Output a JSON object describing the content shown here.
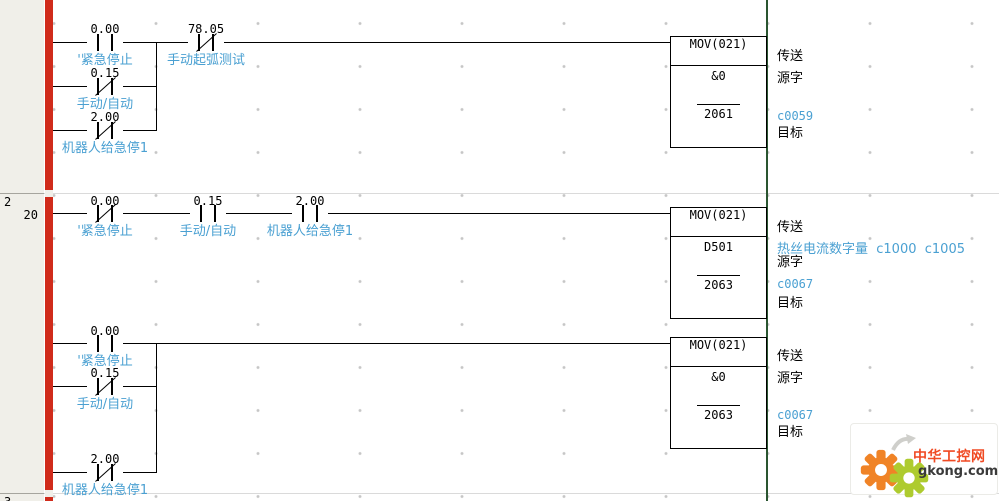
{
  "editor": {
    "left_margin": {
      "rung2_number": "2",
      "rung2_step": "20",
      "rung3_number": "3"
    }
  },
  "colors": {
    "left_bus_bar": "#d02b1b",
    "right_rail": "#2a5530",
    "comment_text": "#4aa0d2",
    "wire": "#000000",
    "margin_bg": "#f0efe9"
  },
  "rung1": {
    "contact_main1": {
      "address": "0.00",
      "label": "'紧急停止",
      "type": "NO"
    },
    "contact_main2": {
      "address": "78.05",
      "label": "手动起弧测试",
      "type": "NC"
    },
    "contact_branch1": {
      "address": "0.15",
      "label": "手动/自动",
      "type": "NC"
    },
    "contact_branch2": {
      "address": "2.00",
      "label": "机器人给急停1",
      "type": "NC"
    },
    "mov": {
      "name": "MOV(021)",
      "source": "&0",
      "dest": "2061"
    },
    "ann_transfer": "传送",
    "ann_source": "源字",
    "ann_dest_comment": "c0059",
    "ann_dest": "目标"
  },
  "rung2": {
    "contact1": {
      "address": "0.00",
      "label": "'紧急停止",
      "type": "NC"
    },
    "contact2": {
      "address": "0.15",
      "label": "手动/自动",
      "type": "NO"
    },
    "contact3": {
      "address": "2.00",
      "label": "机器人给急停1",
      "type": "NO"
    },
    "mov": {
      "name": "MOV(021)",
      "source": "D501",
      "dest": "2063"
    },
    "ann_transfer": "传送",
    "ann_source_comment": "热丝电流数字量  c1000  c1005",
    "ann_source": "源字",
    "ann_dest_comment": "c0067",
    "ann_dest": "目标"
  },
  "rung3": {
    "contact_main": {
      "address": "0.00",
      "label": "'紧急停止",
      "type": "NO"
    },
    "contact_branch1": {
      "address": "0.15",
      "label": "手动/自动",
      "type": "NC"
    },
    "contact_branch2": {
      "address": "2.00",
      "label": "机器人给急停1",
      "type": "NC"
    },
    "mov": {
      "name": "MOV(021)",
      "source": "&0",
      "dest": "2063"
    },
    "ann_transfer": "传送",
    "ann_source": "源字",
    "ann_dest_comment": "c0067",
    "ann_dest": "目标"
  },
  "watermark": {
    "site_name": "中华工控网",
    "site_url": "gkong.com"
  }
}
